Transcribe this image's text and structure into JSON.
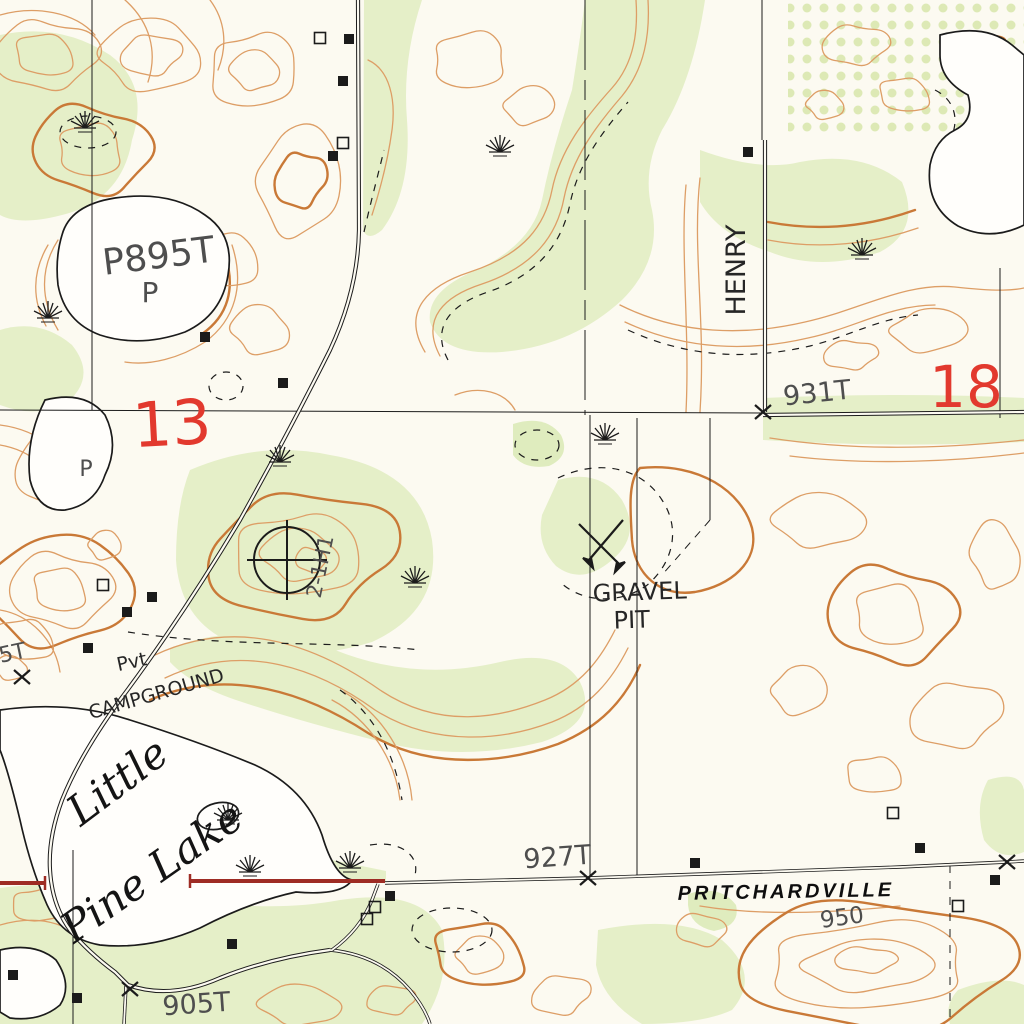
{
  "map": {
    "title": "USGS-style topographic quadrangle excerpt",
    "colors": {
      "paper": "#fcfaf1",
      "contour": "#dd9e66",
      "contour_index": "#c97937",
      "vegetation": "#e5efc8",
      "orchard_dot": "#d7e7ab",
      "water_outline": "#1b1b1b",
      "road_red": "#9e2c24",
      "section_number_red": "#e2392e",
      "ink": "#1b1b1b"
    },
    "section_numbers": [
      {
        "text": "13"
      },
      {
        "text": "18"
      }
    ],
    "labels": [
      {
        "name": "lake-elevation-895",
        "text": "P895T",
        "x": 160,
        "y": 268,
        "rot": -7,
        "size": 36,
        "cls": "lbl-hand"
      },
      {
        "name": "lake-elevation-895-p",
        "text": "P",
        "x": 150,
        "y": 302,
        "rot": 0,
        "size": 28,
        "cls": "lbl-hand"
      },
      {
        "name": "pond-letter-p",
        "text": "P",
        "x": 86,
        "y": 476,
        "rot": 0,
        "size": 22,
        "cls": "lbl-hand"
      },
      {
        "name": "section-number-13",
        "text": "13",
        "x": 173,
        "y": 445,
        "rot": -3,
        "size": 62,
        "cls": "lbl-red"
      },
      {
        "name": "section-number-18",
        "text": "18",
        "x": 966,
        "y": 407,
        "rot": 0,
        "size": 58,
        "cls": "lbl-red"
      },
      {
        "name": "road-name-henry",
        "text": "HENRY",
        "x": 745,
        "y": 270,
        "rot": -90,
        "size": 27,
        "cls": "lbl-handdark"
      },
      {
        "name": "spot-elevation-931",
        "text": "931T",
        "x": 818,
        "y": 402,
        "rot": -6,
        "size": 27,
        "cls": "lbl-hand"
      },
      {
        "name": "gravel-pit-label-line1",
        "text": "GRAVEL",
        "x": 640,
        "y": 600,
        "rot": -2,
        "size": 24,
        "cls": "lbl-handdark"
      },
      {
        "name": "gravel-pit-label-line2",
        "text": "PIT",
        "x": 632,
        "y": 628,
        "rot": -2,
        "size": 24,
        "cls": "lbl-handdark"
      },
      {
        "name": "well-name-label",
        "text": "2-1H1",
        "x": 327,
        "y": 568,
        "rot": -78,
        "size": 21,
        "cls": "lbl-hand"
      },
      {
        "name": "campground-label-line1",
        "text": "Pvt",
        "x": 133,
        "y": 668,
        "rot": -12,
        "size": 19,
        "cls": "lbl-handdark"
      },
      {
        "name": "campground-label-line2",
        "text": "CAMPGROUND",
        "x": 158,
        "y": 700,
        "rot": -16,
        "size": 19,
        "cls": "lbl-handdark"
      },
      {
        "name": "lake-name-line1",
        "text": "Little",
        "x": 126,
        "y": 793,
        "rot": -37,
        "size": 42,
        "cls": "lbl-lake"
      },
      {
        "name": "lake-name-line2",
        "text": "Pine Lake",
        "x": 160,
        "y": 884,
        "rot": -35,
        "size": 42,
        "cls": "lbl-lake"
      },
      {
        "name": "spot-elevation-927",
        "text": "927T",
        "x": 558,
        "y": 866,
        "rot": -4,
        "size": 27,
        "cls": "lbl-hand"
      },
      {
        "name": "town-name-pritchardville",
        "text": "PRITCHARDVILLE",
        "x": 786,
        "y": 898,
        "rot": -1,
        "size": 20,
        "cls": "lbl-road"
      },
      {
        "name": "spot-elevation-950",
        "text": "950",
        "x": 843,
        "y": 925,
        "rot": -8,
        "size": 23,
        "cls": "lbl-hand"
      },
      {
        "name": "spot-elevation-905",
        "text": "905T",
        "x": 197,
        "y": 1013,
        "rot": -4,
        "size": 27,
        "cls": "lbl-hand"
      },
      {
        "name": "edge-elevation-partial",
        "text": "5T",
        "x": 14,
        "y": 660,
        "rot": -12,
        "size": 22,
        "cls": "lbl-hand"
      }
    ],
    "symbols": {
      "marsh": [
        [
          85,
          128
        ],
        [
          48,
          318
        ],
        [
          500,
          152
        ],
        [
          862,
          255
        ],
        [
          280,
          462
        ],
        [
          605,
          440
        ],
        [
          415,
          583
        ],
        [
          228,
          820
        ],
        [
          250,
          872
        ],
        [
          350,
          868
        ]
      ],
      "buildings_filled": [
        [
          349,
          39
        ],
        [
          343,
          81
        ],
        [
          333,
          156
        ],
        [
          205,
          337
        ],
        [
          283,
          383
        ],
        [
          748,
          152
        ],
        [
          152,
          597
        ],
        [
          127,
          612
        ],
        [
          88,
          648
        ],
        [
          13,
          975
        ],
        [
          77,
          998
        ],
        [
          390,
          896
        ],
        [
          920,
          848
        ],
        [
          995,
          880
        ],
        [
          232,
          944
        ],
        [
          695,
          863
        ]
      ],
      "buildings_hollow": [
        [
          320,
          38
        ],
        [
          343,
          143
        ],
        [
          375,
          907
        ],
        [
          367,
          919
        ],
        [
          893,
          813
        ],
        [
          958,
          906
        ],
        [
          103,
          585
        ]
      ],
      "x_marks": [
        [
          763,
          412
        ],
        [
          588,
          878
        ],
        [
          130,
          989
        ],
        [
          1007,
          862
        ],
        [
          22,
          677
        ]
      ],
      "well": [
        287,
        560
      ],
      "gravel_pit": [
        605,
        548
      ]
    }
  }
}
